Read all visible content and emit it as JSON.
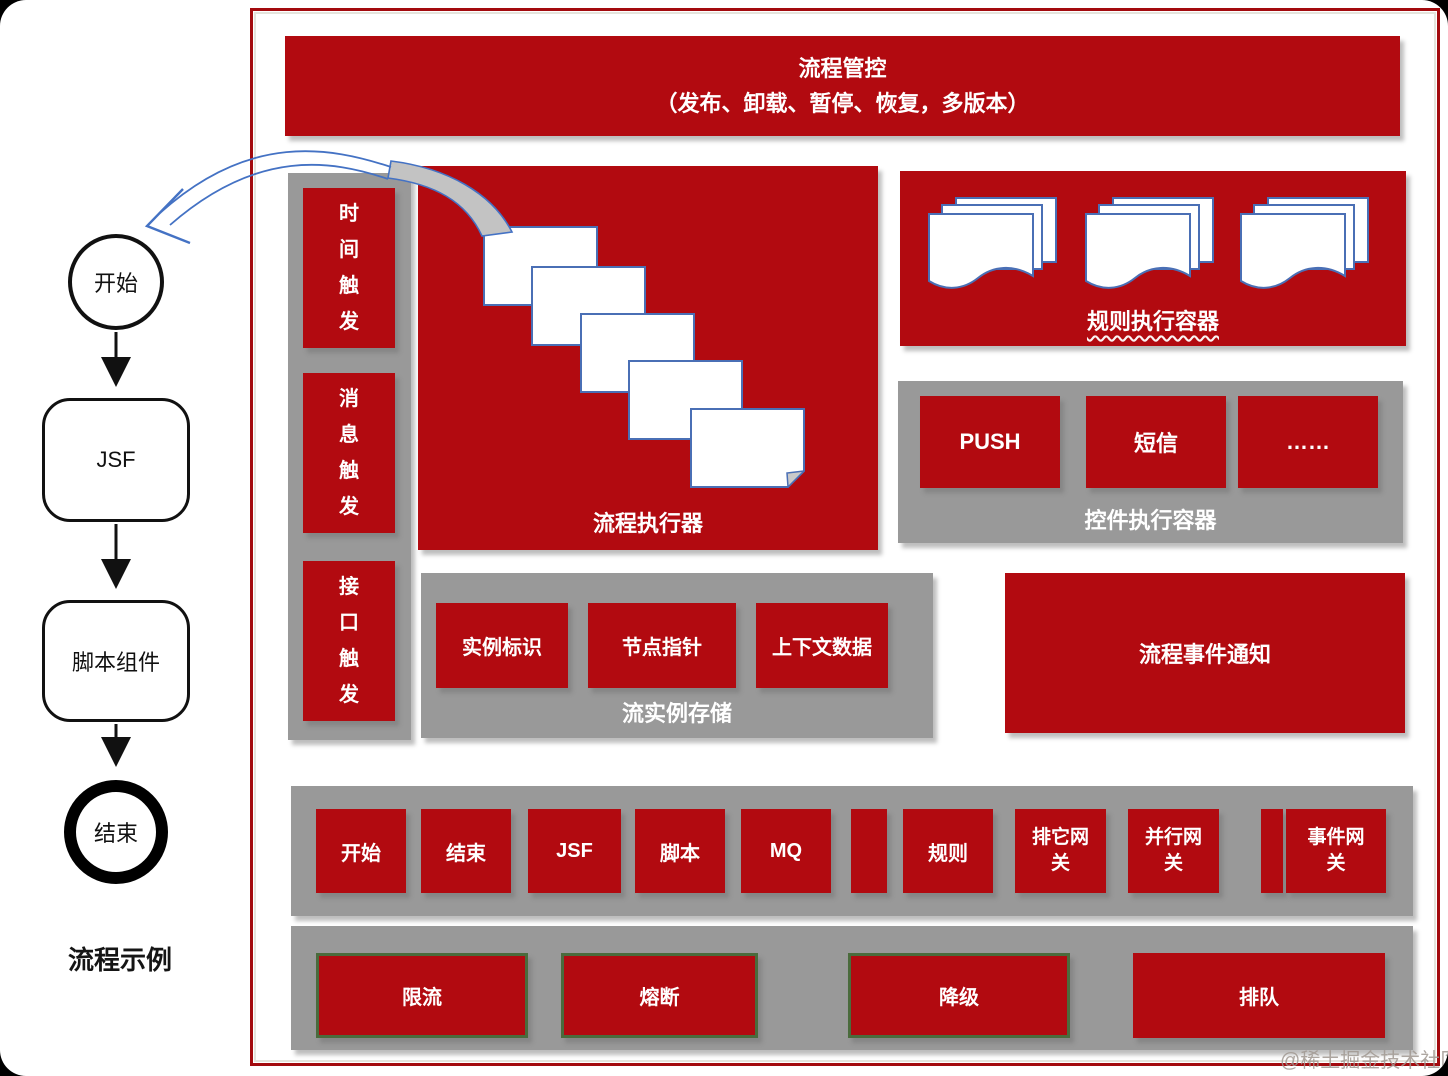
{
  "banner": {
    "line1": "流程管控",
    "line2": "（发布、卸载、暂停、恢复，多版本）"
  },
  "flow_example": {
    "start": "开始",
    "jsf": "JSF",
    "script": "脚本组件",
    "end": "结束",
    "caption": "流程示例"
  },
  "triggers": {
    "items": [
      "时间触发",
      "消息触发",
      "接口触发"
    ]
  },
  "executor": {
    "label": "流程执行器"
  },
  "rule_container": {
    "label": "规则执行容器"
  },
  "widget_container": {
    "label": "控件执行容器",
    "items": [
      "PUSH",
      "短信",
      "……"
    ]
  },
  "instance_store": {
    "label": "流实例存储",
    "items": [
      "实例标识",
      "节点指针",
      "上下文数据"
    ]
  },
  "event_notify": {
    "label": "流程事件通知"
  },
  "node_row": {
    "items": [
      "开始",
      "结束",
      "JSF",
      "脚本",
      "MQ",
      "规则",
      "排它网关",
      "并行网关",
      "事件网关"
    ]
  },
  "resilience_row": {
    "items": [
      "限流",
      "熔断",
      "降级",
      "排队"
    ]
  },
  "watermark": "@稀土掘金技术社区",
  "colors": {
    "red": "#B20A10",
    "gray": "#999999",
    "green_border": "#4A6B3C",
    "page_border_blue": "#4A6FB5",
    "arrow_blue": "#4472C4"
  }
}
